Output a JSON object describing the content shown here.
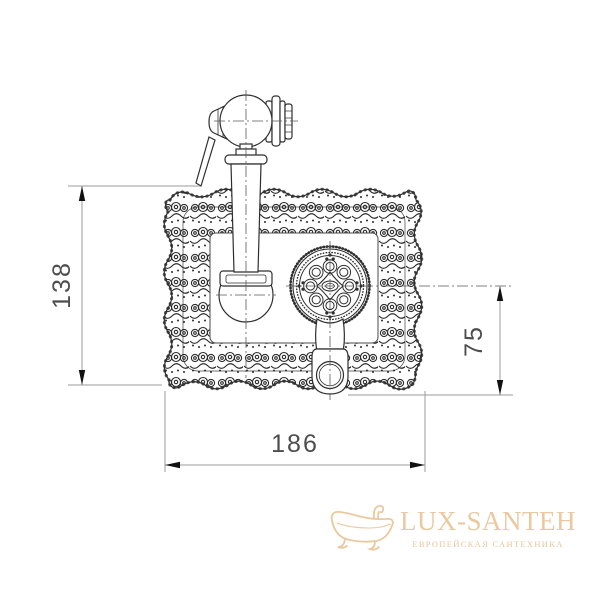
{
  "drawing": {
    "description": "dimension drawing of ornate concealed shower mixer plate with hand shower holder and thermostat lever dial",
    "colors": {
      "outline": "#2f2f2f",
      "pattern": "#2b2b2b",
      "dim_line": "#9b9b9b",
      "arrow": "#111111",
      "centerline": "#5a5a5a",
      "dim_text": "#4d4d4d"
    },
    "dimensions": {
      "plate_height": "138",
      "lever_offset": "75",
      "plate_width": "186"
    }
  },
  "watermark": {
    "icon": "bathtub-icon",
    "brand": "LUX-SANTEH",
    "tagline": "ЕВРОПЕЙСКАЯ САНТЕХНИКА",
    "color": "#eac9a0"
  }
}
